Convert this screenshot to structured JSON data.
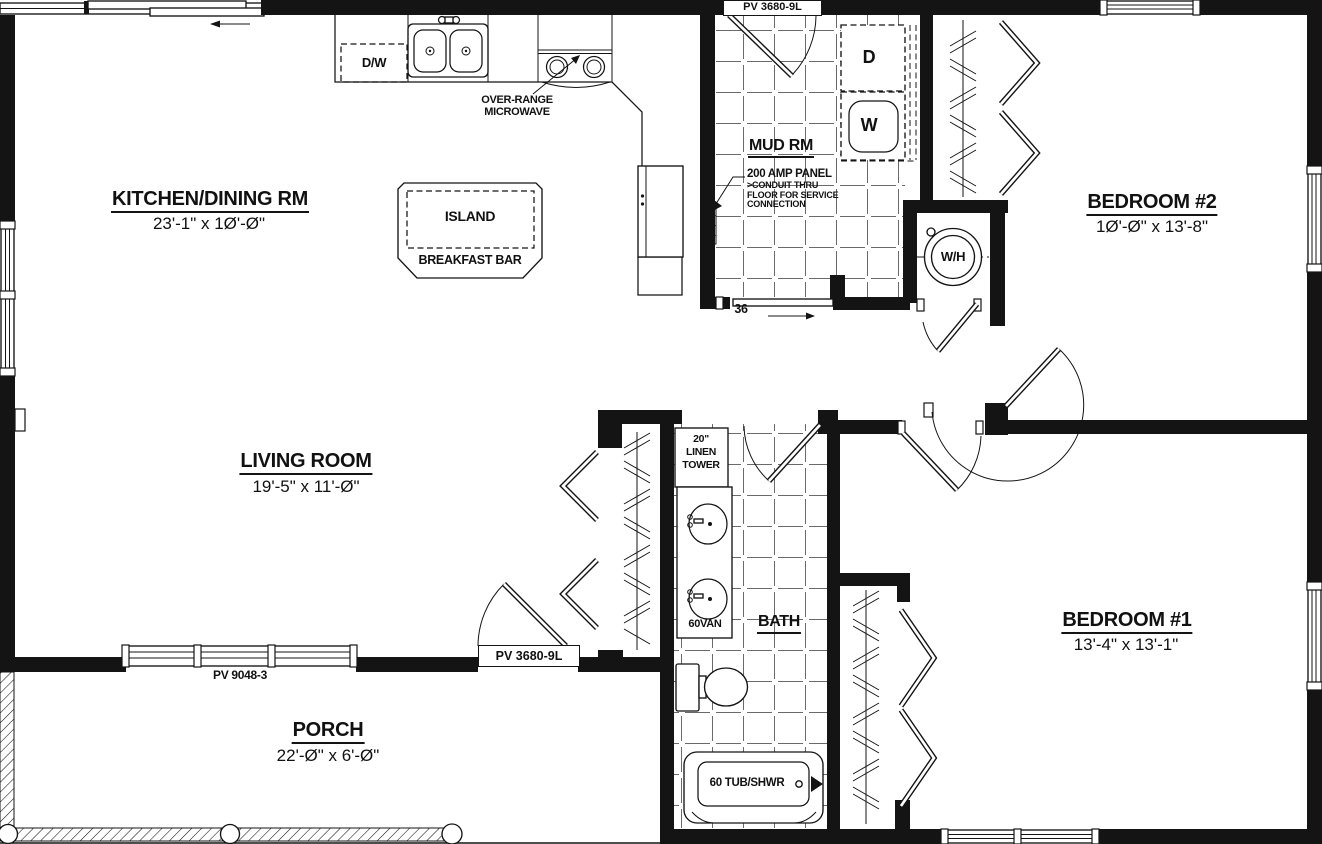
{
  "plan": {
    "rooms": {
      "kitchen": {
        "title": "KITCHEN/DINING RM",
        "dims": "23'-1\" x 1Ø'-Ø\""
      },
      "living": {
        "title": "LIVING ROOM",
        "dims": "19'-5\" x 11'-Ø\""
      },
      "bedroom2": {
        "title": "BEDROOM #2",
        "dims": "1Ø'-Ø\" x 13'-8\""
      },
      "bedroom1": {
        "title": "BEDROOM #1",
        "dims": "13'-4\" x 13'-1\""
      },
      "porch": {
        "title": "PORCH",
        "dims": "22'-Ø\" x 6'-Ø\""
      },
      "mudroom": {
        "title": "MUD RM"
      },
      "bath": {
        "title": "BATH"
      }
    },
    "fixtures": {
      "island": "ISLAND",
      "breakfast_bar": "BREAKFAST BAR",
      "dishwasher": "D/W",
      "microwave_line1": "OVER-RANGE",
      "microwave_line2": "MICROWAVE",
      "dryer": "D",
      "washer": "W",
      "water_heater": "W/H",
      "linen_line1": "20\"",
      "linen_line2": "LINEN",
      "linen_line3": "TOWER",
      "vanity": "60VAN",
      "tub": "60 TUB/SHWR"
    },
    "annotations": {
      "panel_line1": "200 AMP PANEL",
      "panel_line2": ">CONDUIT THRU",
      "panel_line3": "FLOOR FOR SERVICE",
      "panel_line4": "CONNECTION",
      "pocket_door_width": "36"
    },
    "openings": {
      "mud_door": "PV 3680-9L",
      "entry_door": "PV 3680-9L",
      "living_window": "PV 9048-3"
    }
  }
}
